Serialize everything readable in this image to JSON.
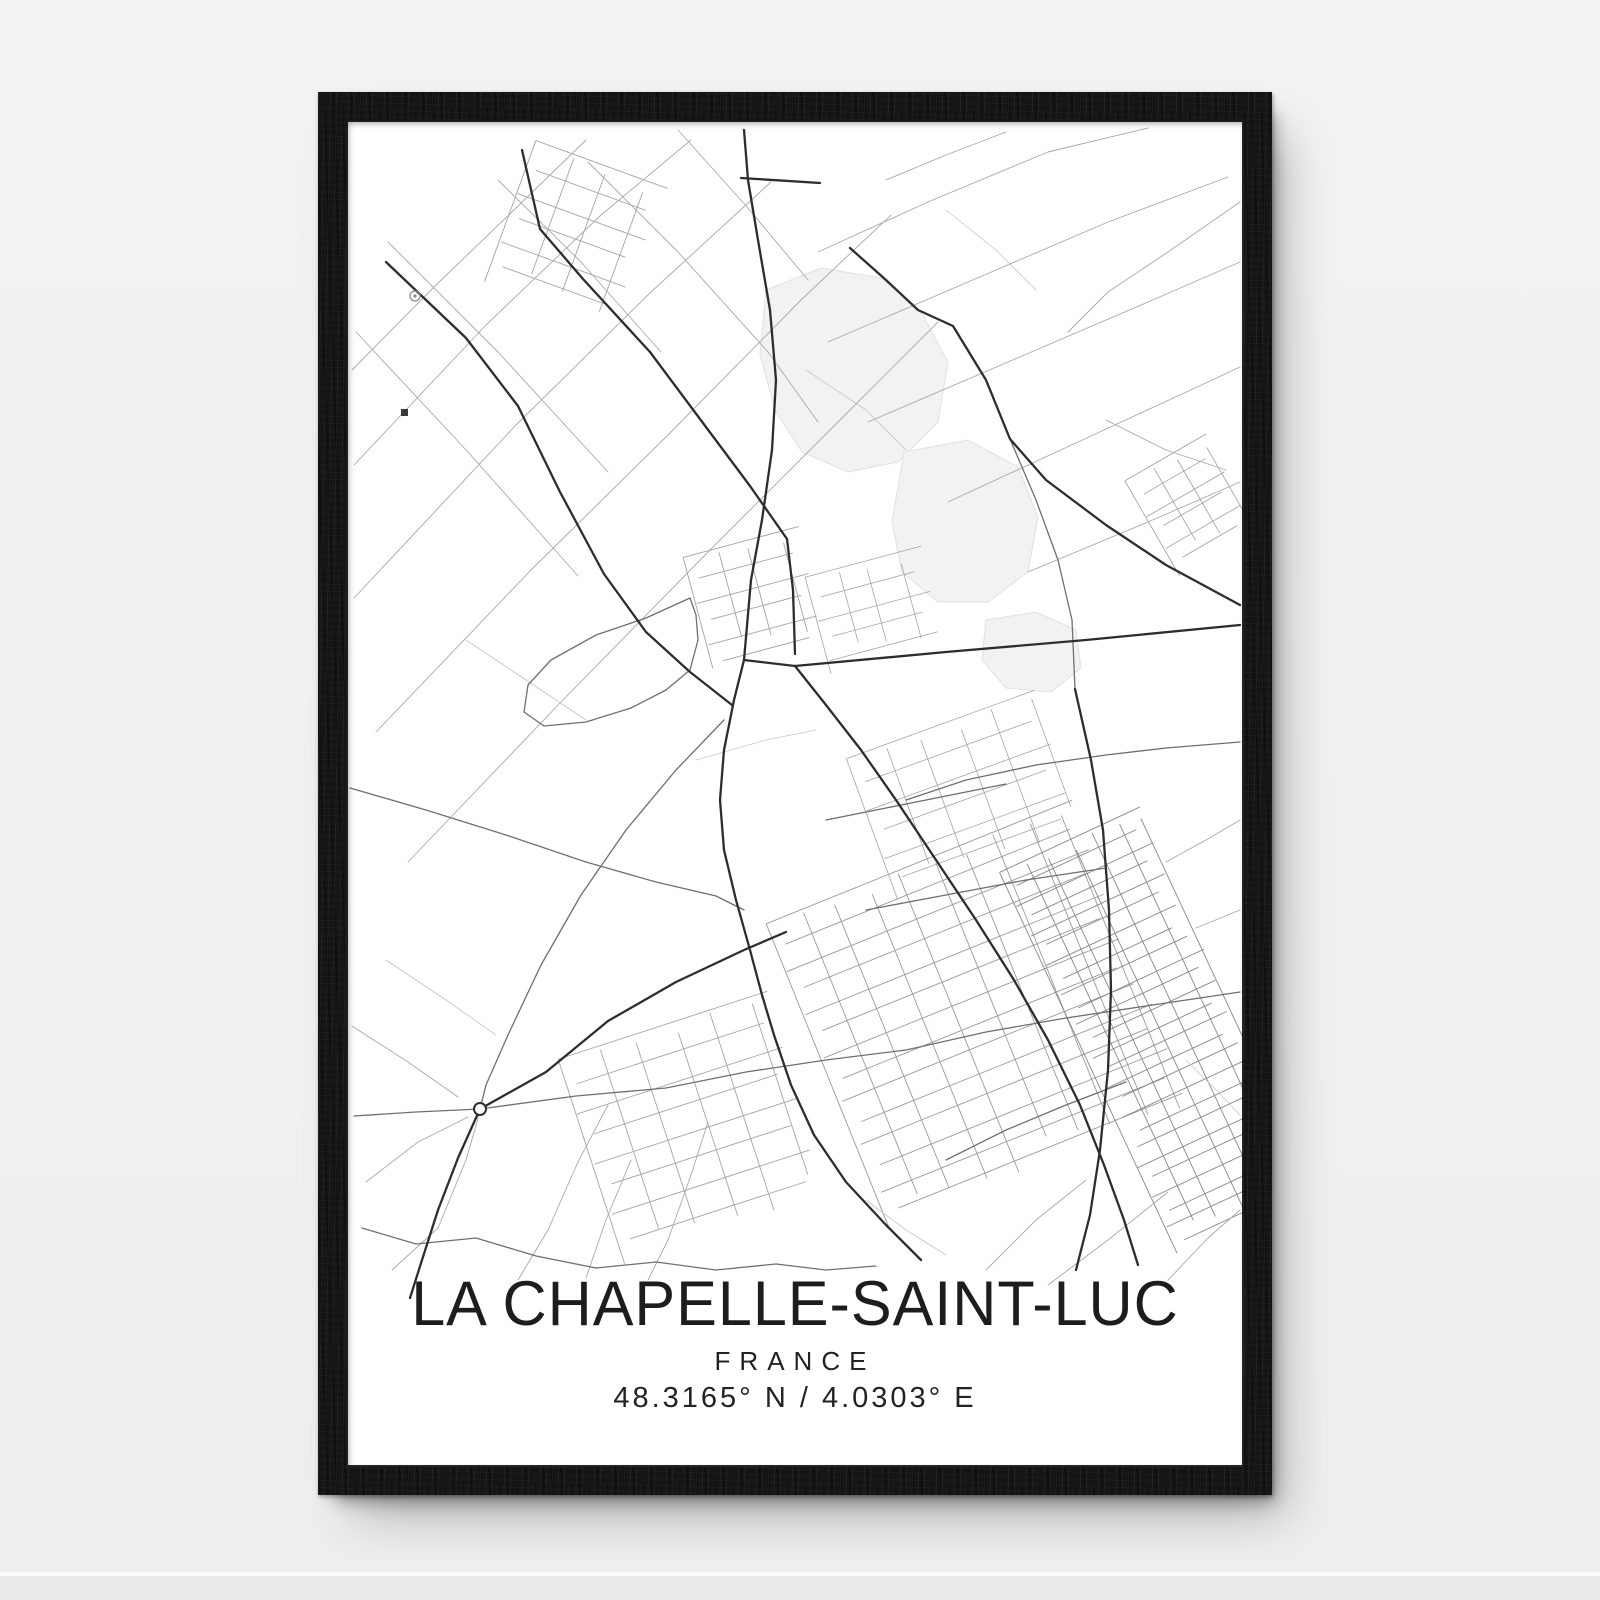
{
  "poster": {
    "title": "LA CHAPELLE-SAINT-LUC",
    "subtitle": "FRANCE",
    "coordinates": "48.3165° N / 4.0303° E"
  },
  "colors": {
    "wall": "#f1f1f2",
    "frame": "#151515",
    "paper": "#ffffff",
    "ink": "#1d1d1d"
  },
  "map": {
    "viewbox": "0 0 898 1190",
    "style": {
      "major_color": "#2d2d2d",
      "major_width": 2.3,
      "medium_color": "#6f6f6f",
      "medium_width": 1.3,
      "minor_color": "#a8a8a8",
      "minor_width": 0.9,
      "faint_color": "#c6c6c6",
      "faint_width": 0.8,
      "blob_fill": "#f2f2f2",
      "blob_stroke": "#e1e1e1"
    },
    "roads": {
      "major": [
        "40,142 120,218 172,286 214,372 258,454 300,512 344,552 386,585",
        "176,30 194,109 237,159 304,232 354,299 404,366 441,419 447,470 449,534",
        "398,10 402,60 412,120 424,190 430,260 426,330 416,400 405,460 398,540",
        "395,58 474,63",
        "398,540 449,546 600,532 740,520 894,505",
        "398,540 388,580 378,630 374,680 378,730 390,780 404,830 416,875 428,915 445,965 468,1015 500,1062 540,1105 575,1140",
        "449,546 480,585 515,630 550,680 590,740 630,800 668,860 702,920 734,985 758,1045 778,1100 792,1145",
        "729,569 745,640 757,710 763,790 765,870 762,950 754,1030 744,1095 730,1150",
        "504,128 540,160 572,190 607,206 640,260 664,319 700,360 760,405 820,445 894,485",
        "134,989 200,952 262,901 330,862 398,830 440,812",
        "134,989 112,1038 92,1090 76,1140 64,1178"
      ],
      "medium": [
        "4,668 80,690 160,715 240,742 310,762 370,776 398,790",
        "8,996 70,992 134,989 230,976 320,968 400,952 480,940 560,930",
        "378,600 330,650 280,710 235,775 195,845 162,915 140,965 134,989",
        "344,478 300,498 250,515 205,540 182,565 178,592 198,606 240,602 285,588 320,570 344,550 352,520 350,495 344,478",
        "664,319 690,380 712,440 726,500 729,569",
        "560,930 640,912 720,898 800,886 894,872",
        "520,790 600,775 680,760 760,748",
        "600,1040 660,1010 720,985 780,962",
        "480,700 540,688 600,676 660,664",
        "560,680 620,660 690,645 760,635 820,628 894,622",
        "16,1108 70,1124 130,1118 190,1136 250,1148 310,1142 370,1150 430,1144",
        "430,1144 480,1150 530,1146"
      ],
      "minor": [
        "8,345 140,205 255,95 345,20",
        "8,478 170,305 305,172 425,62",
        "30,612 185,450 325,312 455,180 545,95",
        "62,742 215,582 362,432 502,292 592,202",
        "6,250 90,165 170,88 240,20",
        "152,60 235,142 315,232",
        "42,122 152,232 262,352",
        "10,212 122,332 232,456",
        "242,42 332,132 422,232 472,302",
        "332,10 402,88 462,160",
        "472,132 582,82 702,32 802,8",
        "482,222 622,162 762,102 882,57",
        "522,302 662,242 802,182 894,142",
        "602,382 732,322 862,262 894,247",
        "682,452 802,402 894,362",
        "540,60 600,35 660,12",
        "894,82 822,132 762,172 722,212",
        "760,300 820,330 880,350",
        "894,700 860,720 820,742",
        "894,790 850,808",
        "20,1062 72,1022 122,997",
        "46,1150 92,1108 120,1040 134,992",
        "172,1160 202,1110 232,1042 262,985",
        "302,1160 322,1120 346,1052 362,1002",
        "6,906 62,942 112,977",
        "240,1158 260,1100 285,1040",
        "822,1160 862,1118 894,1090",
        "702,1165 762,1120 822,1072",
        "640,1150 690,1100 740,1060"
      ],
      "faint": [
        "350,640 420,620 470,610",
        "460,250 520,290 560,330",
        "600,90 650,130 690,170",
        "120,520 180,560 240,600",
        "40,840 100,880 150,915",
        "520,1080 560,1110 600,1135",
        "840,940 870,970 894,995"
      ]
    },
    "blobs": [
      "420,170 475,148 535,158 575,192 602,242 592,302 552,342 502,352 456,332 430,292 414,235",
      "558,332 622,320 672,347 692,397 682,452 642,482 592,482 556,452 546,402",
      "640,500 690,492 730,510 735,548 705,572 660,568 636,540"
    ],
    "clusters": [
      {
        "x": 470,
        "y": 730,
        "w": 330,
        "h": 330,
        "angle": -22,
        "spacing": 24,
        "color": "#8f8f8f",
        "width": 0.9
      },
      {
        "x": 240,
        "y": 900,
        "w": 220,
        "h": 215,
        "angle": -18,
        "spacing": 27,
        "color": "#9b9b9b",
        "width": 0.9
      },
      {
        "x": 160,
        "y": 40,
        "w": 140,
        "h": 150,
        "angle": 20,
        "spacing": 26,
        "color": "#9b9b9b",
        "width": 0.9
      },
      {
        "x": 350,
        "y": 420,
        "w": 120,
        "h": 115,
        "angle": -15,
        "spacing": 22,
        "color": "#999999",
        "width": 0.9
      },
      {
        "x": 735,
        "y": 700,
        "w": 155,
        "h": 420,
        "angle": -25,
        "spacing": 17,
        "color": "#7a7a7a",
        "width": 0.9
      },
      {
        "x": 520,
        "y": 600,
        "w": 200,
        "h": 150,
        "angle": -20,
        "spacing": 26,
        "color": "#9b9b9b",
        "width": 0.8
      },
      {
        "x": 470,
        "y": 440,
        "w": 120,
        "h": 100,
        "angle": -15,
        "spacing": 21,
        "color": "#9b9b9b",
        "width": 0.8
      },
      {
        "x": 800,
        "y": 330,
        "w": 94,
        "h": 110,
        "angle": -30,
        "spacing": 19,
        "color": "#949494",
        "width": 0.8
      }
    ],
    "symbols": {
      "circle_dot": {
        "x": 69,
        "y": 176,
        "r": 5
      },
      "small_square": {
        "x": 55,
        "y": 289,
        "size": 7
      },
      "roundabout": {
        "x": 134,
        "y": 989,
        "r": 6
      }
    }
  }
}
